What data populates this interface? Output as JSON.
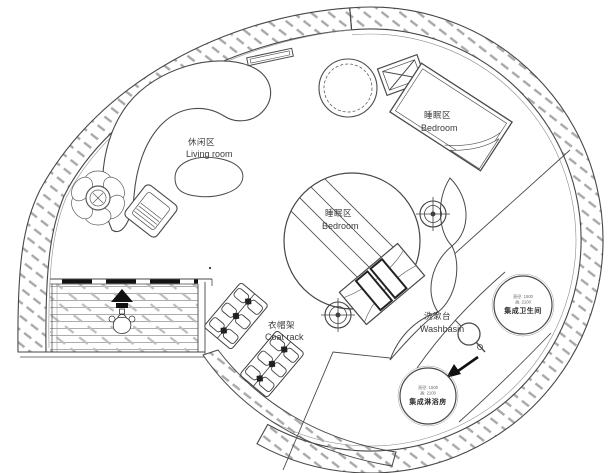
{
  "plan": {
    "title": "circular-floorplan",
    "areas": {
      "living_room": {
        "zh": "休闲区",
        "en": "Living room"
      },
      "bedroom_upper": {
        "zh": "睡眠区",
        "en": "Bedroom"
      },
      "bedroom_center": {
        "zh": "睡眠区",
        "en": "Bedroom"
      },
      "coat_rack": {
        "zh": "衣帽架",
        "en": "Coat rack"
      },
      "washbasin": {
        "zh": "洗漱台",
        "en": "Washbasin"
      }
    },
    "pods": {
      "bathroom": {
        "name": "集成卫生间",
        "dim_diameter": "直径: 1500",
        "dim_height": "高: 2100"
      },
      "shower": {
        "name": "集成淋浴房",
        "dim_diameter": "直径: 1500",
        "dim_height": "高: 2100"
      }
    },
    "colors": {
      "line": "#474747",
      "wall_hatch": "#a8a8a8",
      "deck_line": "#8a8a8a",
      "accent_black": "#111111",
      "background": "#ffffff"
    }
  }
}
